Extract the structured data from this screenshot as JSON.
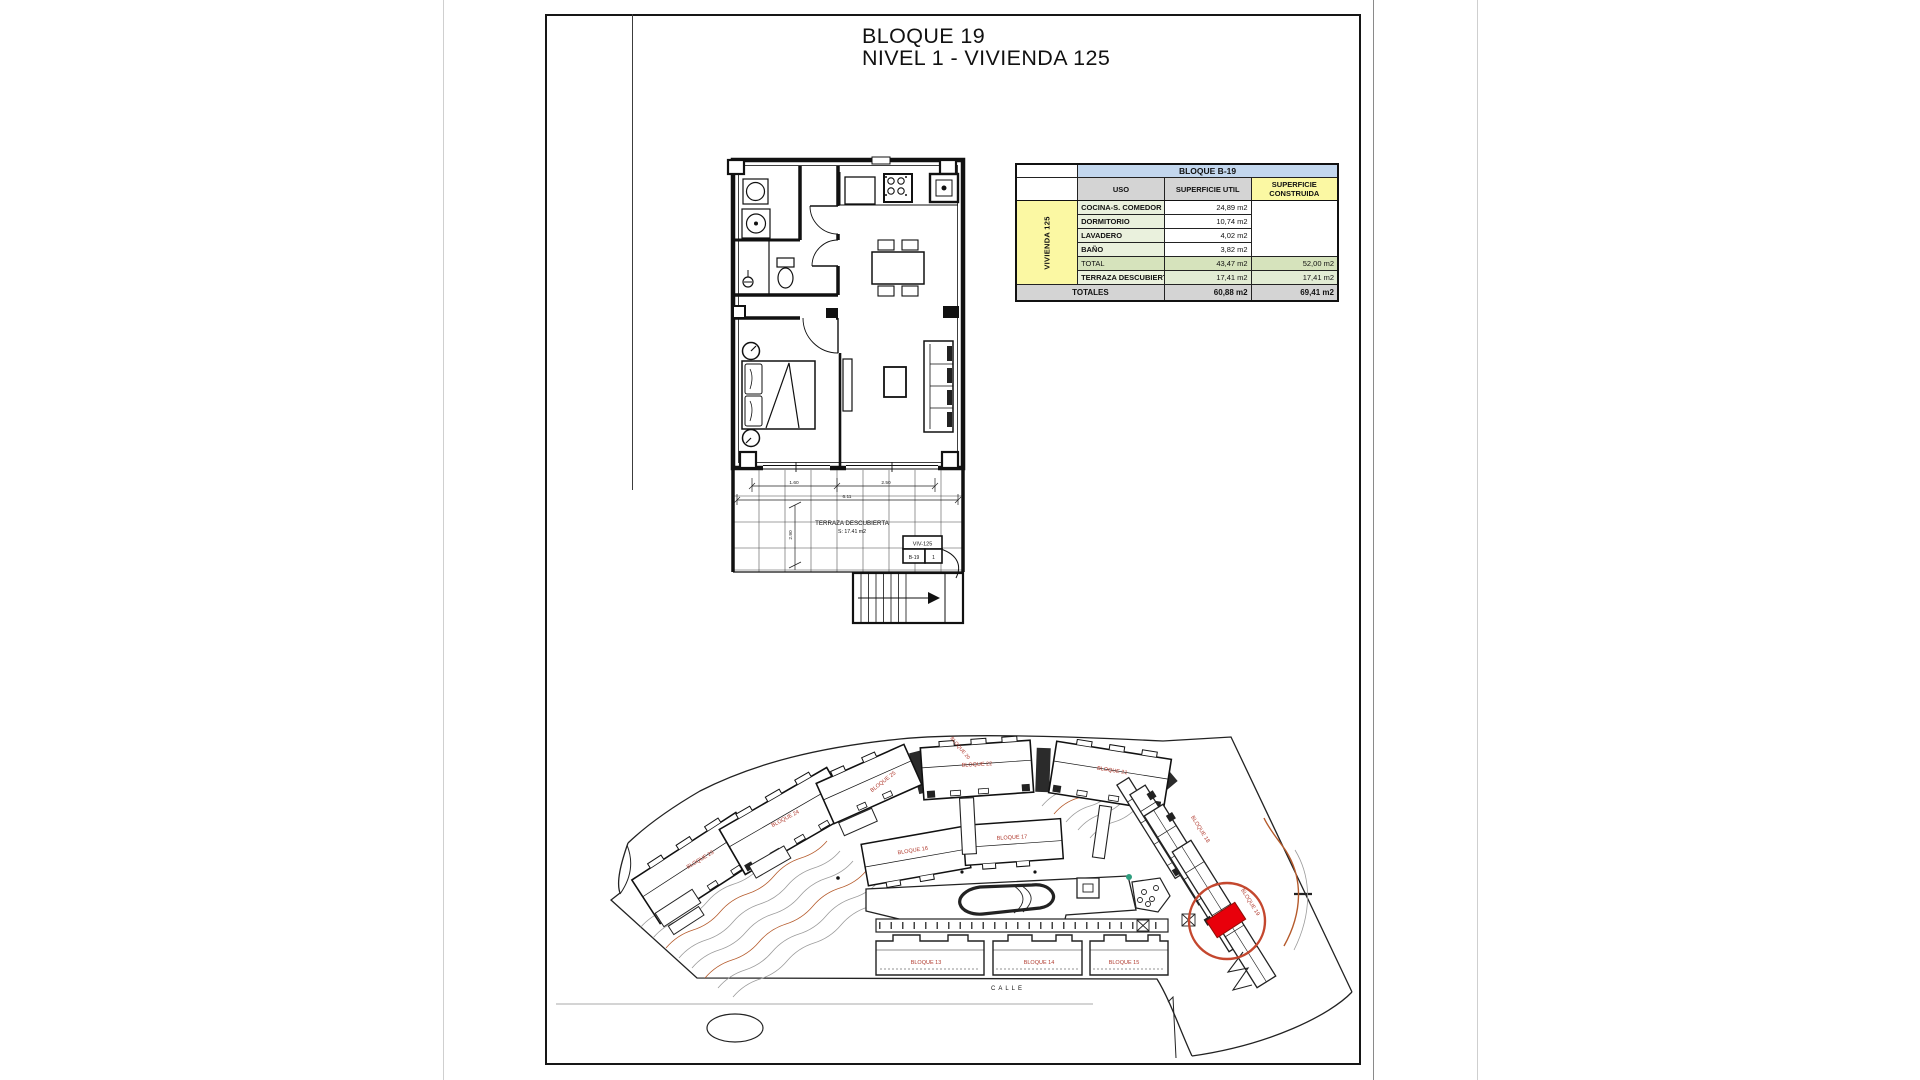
{
  "page": {
    "title_line1": "BLOQUE 19",
    "title_line2": "NIVEL 1 - VIVIENDA 125"
  },
  "area_table": {
    "header": "BLOQUE B-19",
    "columns": {
      "uso": "USO",
      "util": "SUPERFICIE UTIL",
      "construida": "SUPERFICIE CONSTRUIDA"
    },
    "row_group_label": "VIVIENDA 125",
    "rows": [
      {
        "uso": "COCINA-S. COMEDOR",
        "util": "24,89 m2"
      },
      {
        "uso": "DORMITORIO",
        "util": "10,74 m2"
      },
      {
        "uso": "LAVADERO",
        "util": "4,02 m2"
      },
      {
        "uso": "BAÑO",
        "util": "3,82 m2"
      }
    ],
    "total": {
      "uso": "TOTAL",
      "util": "43,47 m2",
      "construida": "52,00 m2"
    },
    "terraza": {
      "uso": "TERRAZA DESCUBIERTA",
      "util": "17,41 m2",
      "construida": "17,41 m2"
    },
    "totales": {
      "label": "TOTALES",
      "util": "60,88 m2",
      "construida": "69,41 m2"
    }
  },
  "floorplan": {
    "terrace_label": "TERRAZA DESCUBIERTA",
    "terrace_area": "S: 17.41 m2",
    "dims": {
      "d1": "1.60",
      "d2": "2.50",
      "total": "6.11",
      "vertical": "2.90"
    },
    "unit_tag": {
      "top": "VIV-125",
      "left": "B-19",
      "right": "1"
    }
  },
  "siteplan": {
    "street": "CALLE",
    "highlight_color": "#e8000b",
    "circle_color": "#c4472e",
    "blocks": [
      "BLOQUE 23",
      "BLOQUE 24",
      "BLOQUE 25",
      "BLOQUE 22",
      "BLOQUE 21",
      "BLOQUE 16",
      "BLOQUE 17",
      "BLOQUE 20",
      "BLOQUE 18",
      "BLOQUE 19",
      "BLOQUE 13",
      "BLOQUE 14",
      "BLOQUE 15"
    ]
  }
}
